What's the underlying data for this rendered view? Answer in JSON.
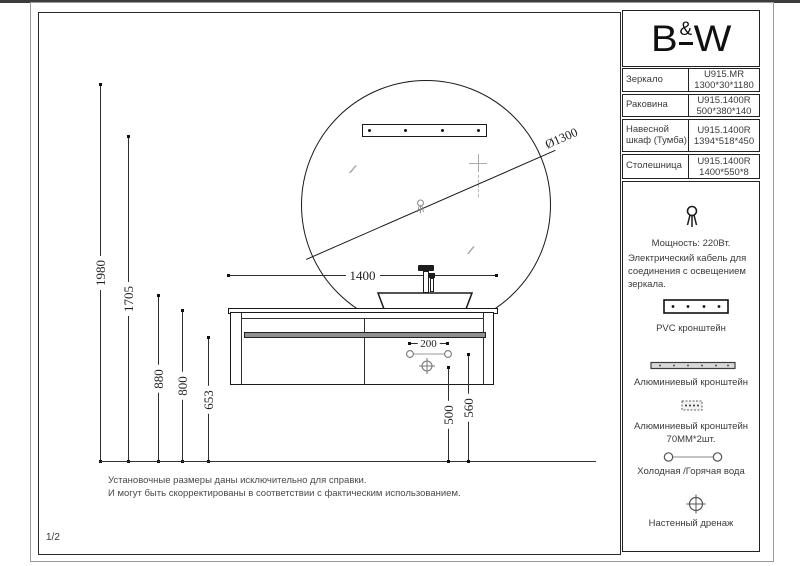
{
  "colors": {
    "line": "#1a1a1a",
    "muted": "#8c8c8c",
    "bar_fill": "#8f8f8f"
  },
  "sheet": {
    "number": "1/2"
  },
  "logo": {
    "b": "B",
    "amp": "&",
    "w": "W"
  },
  "spec_table": {
    "rows": [
      {
        "label": "Зеркало",
        "code": "U915.MR",
        "size": "1300*30*1180"
      },
      {
        "label": "Раковина",
        "code": "U915.1400R",
        "size": "500*380*140"
      },
      {
        "label": "Навесной шкаф (Тумба)",
        "code": "U915.1400R",
        "size": "1394*518*450"
      },
      {
        "label": "Столешница",
        "code": "U915.1400R",
        "size": "1400*550*8"
      }
    ]
  },
  "notes_panel": {
    "power_title": "Мощность: 220Вт.",
    "power_lines": [
      "Электрический кабель для",
      "соединения с освещением",
      "зеркала."
    ],
    "pvc_label": "PVC кронштейн",
    "alu_label": "Алюминиевый кронштейн",
    "alu_small_label": "Алюминиевый кронштейн",
    "alu_small_qty": "70MM*2шт.",
    "water_label": "Холодная /Горячая вода",
    "drain_label": "Настенный дренаж",
    "icons": [
      "power-cable-icon",
      "pvc-bracket-icon",
      "aluminum-bracket-icon",
      "aluminum-bracket-small-icon",
      "water-connections-icon",
      "wall-drain-icon"
    ]
  },
  "drawing": {
    "dims": {
      "diameter": "Ø1300",
      "d1400": "1400",
      "d200": "200",
      "h1980": "1980",
      "h1705": "1705",
      "h880": "880",
      "h800": "800",
      "h653": "653",
      "h560": "560",
      "h500": "500"
    },
    "footnote": [
      "Установочные размеры даны исключительно для справки.",
      "И могут быть скорректированы в соответствии с фактическим использованием."
    ]
  }
}
